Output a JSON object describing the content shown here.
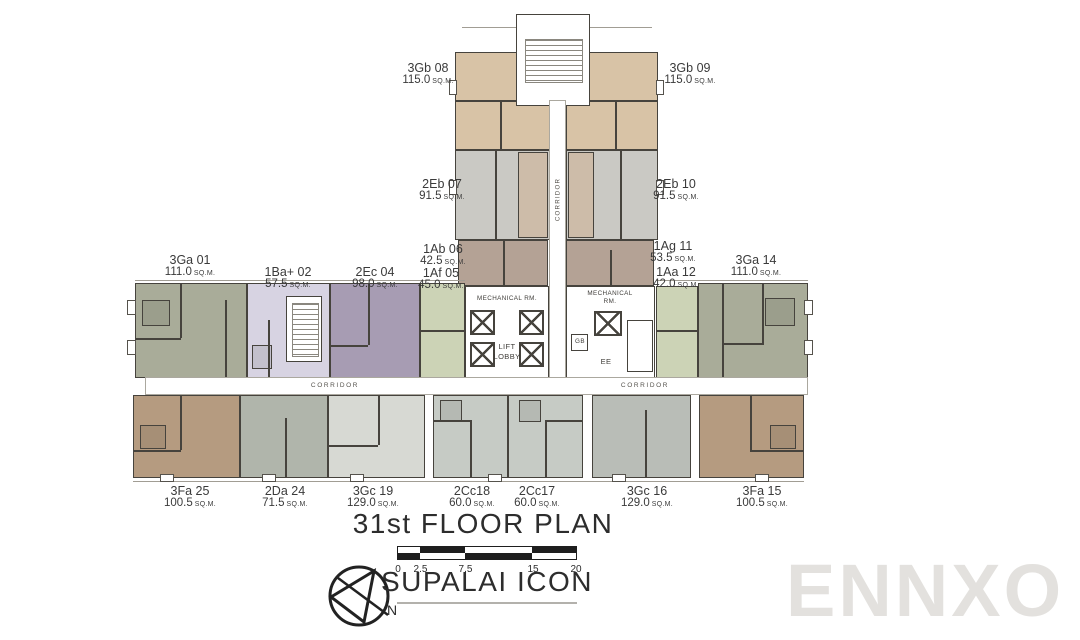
{
  "title": "31st FLOOR PLAN",
  "project": "SUPALAI ICON",
  "watermark": "ENNXO",
  "compass_label": "N",
  "sqm": "SQ.M.",
  "scale_ticks": [
    "0",
    "2.5",
    "7.5",
    "15",
    "20"
  ],
  "corridor": {
    "vertical": "CORRIDOR",
    "left": "CORRIDOR",
    "right": "CORRIDOR"
  },
  "core": {
    "mech_left": "MECHANICAL RM.",
    "mech_right_1": "MECHANICAL",
    "mech_right_2": "RM.",
    "lift_1": "LIFT",
    "lift_2": "LOBBY",
    "gb": "GB",
    "ee": "EE"
  },
  "units": [
    {
      "name": "3Gb 08",
      "area": "115.0",
      "color": "#d8c3a6"
    },
    {
      "name": "3Gb 09",
      "area": "115.0",
      "color": "#d8c3a6"
    },
    {
      "name": "2Eb 07",
      "area": "91.5",
      "color": "#cac9c4"
    },
    {
      "name": "2Eb 10",
      "area": "91.5",
      "color": "#cac9c4"
    },
    {
      "name": "1Ab 06",
      "area": "42.5",
      "color": "#b4a295"
    },
    {
      "name": "1Ag 11",
      "area": "53.5",
      "color": "#b4a295"
    },
    {
      "name": "1Af 05",
      "area": "45.0",
      "color": "#ccd3b6"
    },
    {
      "name": "1Aa 12",
      "area": "42.0",
      "color": "#ccd3b6"
    },
    {
      "name": "3Ga 01",
      "area": "111.0",
      "color": "#a9ac99"
    },
    {
      "name": "1Ba+ 02",
      "area": "57.5",
      "color": "#d7d3e2"
    },
    {
      "name": "2Ec 04",
      "area": "98.0",
      "color": "#a79cb3"
    },
    {
      "name": "3Ga 14",
      "area": "111.0",
      "color": "#a9ac99"
    },
    {
      "name": "3Fa 25",
      "area": "100.5",
      "color": "#b59b80"
    },
    {
      "name": "2Da 24",
      "area": "71.5",
      "color": "#b0b5ab"
    },
    {
      "name": "3Gc 19",
      "area": "129.0",
      "color": "#d7d9d3"
    },
    {
      "name": "2Cc18",
      "area": "60.0",
      "color": "#c6cbc5"
    },
    {
      "name": "2Cc17",
      "area": "60.0",
      "color": "#c6cbc5"
    },
    {
      "name": "3Gc 16",
      "area": "129.0",
      "color": "#b9bdb7"
    },
    {
      "name": "3Fa 15",
      "area": "100.5",
      "color": "#b59b80"
    }
  ]
}
